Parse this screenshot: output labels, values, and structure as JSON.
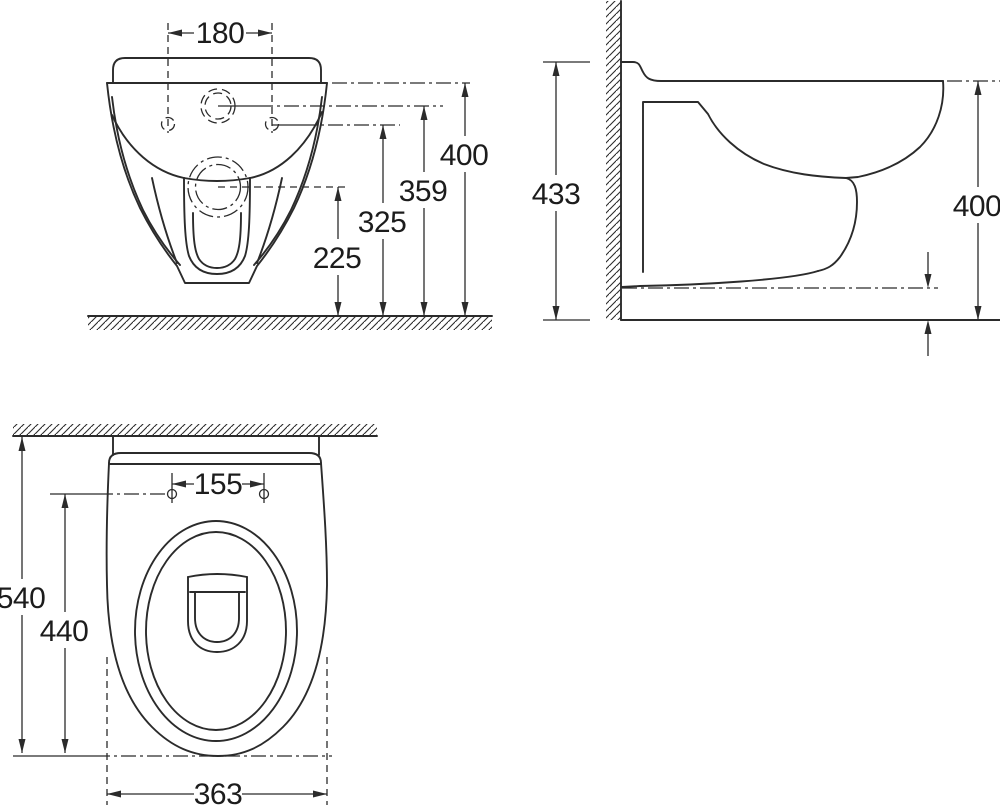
{
  "drawing": {
    "type": "technical-dimension-drawing",
    "colors": {
      "line": "#2b2b2b",
      "text": "#1c1c1c",
      "background": "#ffffff"
    },
    "views": {
      "front": {
        "dims": {
          "hole_spacing": "180",
          "overall_height": "400",
          "inlet_height": "359",
          "fixing_height": "325",
          "outlet_height": "225"
        }
      },
      "side": {
        "dims": {
          "overall_height": "433",
          "rim_height": "400"
        }
      },
      "plan": {
        "dims": {
          "fixing_spacing": "155",
          "overall_depth": "540",
          "bowl_depth": "440",
          "width": "363"
        }
      }
    }
  }
}
